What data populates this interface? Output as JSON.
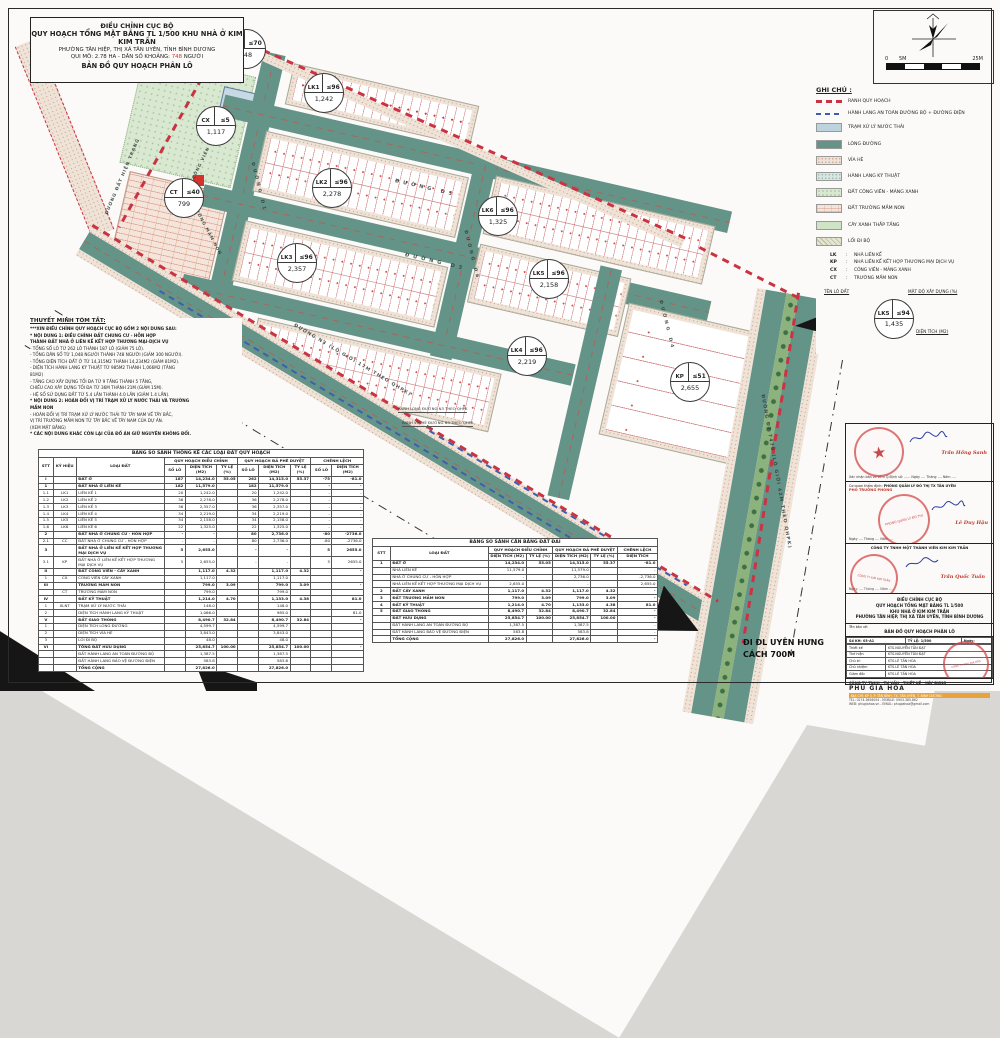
{
  "colors": {
    "road_teal": "#649387",
    "boundary_red": "#c93342",
    "corridor_blue": "#3f5fae",
    "pop_red": "#d4322a",
    "stamp_red": "#cf3e3e"
  },
  "title_block": {
    "line1": "ĐIỀU CHỈNH CỤC BỘ",
    "line2": "QUY HOẠCH TỔNG MẶT BẰNG TL 1/500 KHU NHÀ Ở KIM KIM TRẦN",
    "line3": "PHƯỜNG TÂN HIỆP, THỊ XÃ TÂN UYÊN, TỈNH BÌNH DƯƠNG",
    "line4_pre": "QUI MÔ: 2.78 HA - DÂN SỐ KHOẢNG:",
    "line4_pop": "748",
    "line4_post": "NGƯỜI",
    "line5": "BẢN ĐỒ QUY HOẠCH PHÂN LÔ"
  },
  "north": {
    "scale_0": "0",
    "scale_5": "5M",
    "scale_25": "25M"
  },
  "legend": {
    "title": "GHI CHÚ :",
    "items": [
      {
        "swatch": "dashred",
        "label": "RANH QUY HOẠCH"
      },
      {
        "swatch": "dashblue",
        "label": "HÀNH LANG AN TOÀN ĐƯỜNG BỘ + ĐƯỜNG ĐIỆN"
      },
      {
        "swatch": "wwtp",
        "label": "TRẠM XỬ LÝ NƯỚC THẢI"
      },
      {
        "swatch": "roadc",
        "label": "LÒNG ĐƯỜNG"
      },
      {
        "swatch": "sidewalk",
        "label": "VỈA HÈ"
      },
      {
        "swatch": "tech",
        "label": "HÀNH LANG KỸ THUẬT"
      },
      {
        "swatch": "parkland",
        "label": "ĐẤT CÔNG VIÊN - MẢNG XANH"
      },
      {
        "swatch": "brickp",
        "label": "ĐẤT TRƯỜNG MẦM NON"
      },
      {
        "swatch": "lowgreen",
        "label": "CÂY XANH THẤP TẦNG"
      },
      {
        "swatch": "walk",
        "label": "LỐI ĐI BỘ"
      }
    ],
    "abbrevs": [
      {
        "key": "LK",
        "label": "NHÀ LIÊN KẾ"
      },
      {
        "key": "KP",
        "label": "NHÀ LIÊN KẾ KẾT HỢP THƯƠNG MẠI DỊCH VỤ"
      },
      {
        "key": "CX",
        "label": "CÔNG VIÊN - MẢNG XANH"
      },
      {
        "key": "CT",
        "label": "TRƯỜNG MẦM NON"
      }
    ],
    "key": {
      "lot": "TÊN LÔ ĐẤT",
      "density": "MẬT ĐỘ XÂY DỰNG (%)",
      "area": "DIỆN TÍCH (M2)",
      "example": {
        "code": "LK5",
        "density": "≤94",
        "area": "1,435"
      }
    }
  },
  "notes": {
    "title": "THUYẾT MINH TÓM TẮT:",
    "lines": [
      {
        "t": "***XIN ĐIỀU CHỈNH QUY HOẠCH CỤC BỘ GỒM 2 NỘI DUNG SAU:",
        "b": true
      },
      {
        "t": "* NỘI DUNG 1: ĐIỀU CHỈNH ĐẤT CHUNG CƯ - HỖN HỢP",
        "b": true
      },
      {
        "t": "THÀNH ĐẤT NHÀ Ở LIÊN KẾ KẾT HỢP THƯƠNG MẠI-DỊCH VỤ",
        "b": true
      },
      {
        "t": "- TỔNG SỐ LÔ TỪ 262 LÔ THÀNH 187 LÔ (GIẢM 75 LÔ).",
        "b": false
      },
      {
        "t": "- TỔNG DÂN SỐ TỪ 1,048 NGƯỜI THÀNH 748 NGƯỜI (GIẢM 300 NGƯỜI).",
        "b": false
      },
      {
        "t": "- TỔNG DIỆN TÍCH ĐẤT Ở TỪ 14,315M2 THÀNH 14,234M2 (GIẢM 81M2).",
        "b": false
      },
      {
        "t": "- DIỆN TÍCH HÀNH LANG KỸ THUẬT TỪ 985M2 THÀNH 1,066M2 (TĂNG",
        "b": false
      },
      {
        "t": "81M2)",
        "b": false
      },
      {
        "t": "- TẦNG CAO XÂY DỰNG TỐI ĐA TỪ 9 TẦNG THÀNH 5 TẦNG,",
        "b": false
      },
      {
        "t": "CHIỀU CAO XÂY DỰNG TỐI ĐA TỪ 36M THÀNH 21M (GIẢM 15M).",
        "b": false
      },
      {
        "t": "- HỆ SỐ SỬ DỤNG ĐẤT TỪ 5.4 LẦN THÀNH 4.0 LẦN (GIẢM 1.4 LẦN).",
        "b": false
      },
      {
        "t": "* NỘI DUNG 2: HOÁN ĐỔI VỊ TRÍ TRẠM XỬ LÝ NƯỚC THẢI VÀ TRƯỜNG",
        "b": true
      },
      {
        "t": "MẦM NON",
        "b": true
      },
      {
        "t": "- HOÁN ĐỔI VỊ TRÍ TRẠM XỬ LÝ NƯỚC THẢI TỪ TÂY NAM VỀ TÂY BẮC,",
        "b": false
      },
      {
        "t": "VỊ TRÍ TRƯỜNG MẦM NON TỪ TÂY BẮC VỀ TÂY NAM CỦA DỰ ÁN.",
        "b": false
      },
      {
        "t": "(XEM MẶT BẰNG)",
        "b": false
      },
      {
        "t": "* CÁC NỘI DUNG KHÁC CÒN LẠI CỦA ĐỒ ÁN GIỮ NGUYÊN KHÔNG ĐỔI.",
        "b": true
      }
    ]
  },
  "map": {
    "xlnt_box": "XLNT",
    "parcels": [
      {
        "code": "XLNT",
        "density": "≤70",
        "area": "148",
        "x": 245,
        "y": 48
      },
      {
        "code": "LK1",
        "density": "≤96",
        "area": "1,242",
        "x": 323,
        "y": 92
      },
      {
        "code": "CX",
        "density": "≤5",
        "area": "1,117",
        "x": 215,
        "y": 125
      },
      {
        "code": "CT",
        "density": "≤40",
        "area": "799",
        "x": 183,
        "y": 197
      },
      {
        "code": "LK2",
        "density": "≤96",
        "area": "2,278",
        "x": 331,
        "y": 187
      },
      {
        "code": "LK6",
        "density": "≤96",
        "area": "1,325",
        "x": 497,
        "y": 215
      },
      {
        "code": "LK3",
        "density": "≤96",
        "area": "2,357",
        "x": 296,
        "y": 262
      },
      {
        "code": "LK5",
        "density": "≤96",
        "area": "2,158",
        "x": 548,
        "y": 278
      },
      {
        "code": "LK4",
        "density": "≤96",
        "area": "2,219",
        "x": 526,
        "y": 355
      },
      {
        "code": "KP",
        "density": "≤51",
        "area": "2,655",
        "x": 689,
        "y": 381
      }
    ],
    "road_labels": [
      {
        "text": "ĐƯỜNG  D5",
        "x": 395,
        "y": 178,
        "rot": 13,
        "ls": 4,
        "fs": 5
      },
      {
        "text": "ĐƯỜNG  D3",
        "x": 405,
        "y": 252,
        "rot": 13,
        "ls": 4,
        "fs": 5
      },
      {
        "text": "ĐƯỜNG D1",
        "x": 252,
        "y": 160,
        "rot": 76,
        "ls": 3,
        "fs": 4.5
      },
      {
        "text": "ĐƯỜNG D6",
        "x": 465,
        "y": 228,
        "rot": 76,
        "ls": 3,
        "fs": 4.5
      },
      {
        "text": "ĐƯỜNG D4",
        "x": 660,
        "y": 298,
        "rot": 76,
        "ls": 3,
        "fs": 4.5
      },
      {
        "text": "ĐƯỜNG  N3  (LỘ GIỚI 17M THEO QHPK)",
        "x": 294,
        "y": 323,
        "rot": 31,
        "ls": 1.2,
        "fs": 4.6
      },
      {
        "text": "ĐƯỜNG  ĐT 747B  (LỘ GIỚI 42M THEO QHPK)",
        "x": 762,
        "y": 392,
        "rot": 80,
        "ls": 1.2,
        "fs": 4.6
      },
      {
        "text": "ĐƯỜNG ĐẤT HIỆN TRẠNG",
        "x": 107,
        "y": 212,
        "rot": -67,
        "ls": 1,
        "fs": 4.4
      },
      {
        "text": "CÔNG VIÊN",
        "x": 193,
        "y": 176,
        "rot": -64,
        "ls": 1,
        "fs": 4.2
      },
      {
        "text": "TRƯỜNG MẦM NON",
        "x": 193,
        "y": 200,
        "rot": 62,
        "ls": 1,
        "fs": 4.2
      }
    ],
    "callouts": [
      {
        "text": "RANH LÒNG ĐƯỜNG N3 THEO QHPK",
        "x": 398,
        "y": 406
      },
      {
        "text": "RANH VỈA HÈ ĐƯỜNG N3 THEO QHPK",
        "x": 402,
        "y": 420
      }
    ],
    "direction_line1": "ĐI ĐL UYÊN HƯNG",
    "direction_line2": "CÁCH 700M"
  },
  "table_left": {
    "title": "BẢNG SO SÁNH THỐNG KÊ CÁC LOẠI ĐẤT QUY HOẠCH",
    "groups": [
      "QUY HOẠCH ĐIỀU CHỈNH",
      "QUY HOẠCH ĐÃ PHÊ DUYỆT",
      "CHÊNH LỆCH"
    ],
    "cols": [
      "STT",
      "KÝ HIỆU",
      "LOẠI ĐẤT",
      "SỐ LÔ",
      "DIỆN TÍCH (M2)",
      "TỶ LỆ (%)",
      "SỐ LÔ",
      "DIỆN TÍCH (M2)",
      "TỶ LỆ (%)",
      "SỐ LÔ",
      "DIỆN TÍCH (M2)"
    ],
    "bold_rows": [
      0,
      1,
      8,
      10,
      12,
      14,
      16,
      19,
      23,
      26
    ],
    "rows": [
      [
        "I",
        "",
        "ĐẤT Ở",
        "187",
        "14,234.0",
        "55.05",
        "262",
        "14,315.0",
        "55.37",
        "-75",
        "-81.0"
      ],
      [
        "1",
        "",
        "ĐẤT NHÀ Ở LIÊN KẾ",
        "182",
        "11,579.0",
        "",
        "182",
        "11,579.0",
        "",
        "-",
        "-"
      ],
      [
        "1.1",
        "LK1",
        "LIÊN KẾ 1",
        "20",
        "1,242.0",
        "",
        "20",
        "1,242.0",
        "",
        "-",
        "-"
      ],
      [
        "1.2",
        "LK2",
        "LIÊN KẾ 2",
        "36",
        "2,278.0",
        "",
        "36",
        "2,278.0",
        "",
        "-",
        "-"
      ],
      [
        "1.3",
        "LK3",
        "LIÊN KẾ 3",
        "36",
        "2,357.0",
        "",
        "36",
        "2,357.0",
        "",
        "-",
        "-"
      ],
      [
        "1.4",
        "LK4",
        "LIÊN KẾ 4",
        "34",
        "2,219.0",
        "",
        "34",
        "2,219.0",
        "",
        "-",
        "-"
      ],
      [
        "1.5",
        "LK5",
        "LIÊN KẾ 5",
        "34",
        "2,158.0",
        "",
        "34",
        "2,158.0",
        "",
        "-",
        "-"
      ],
      [
        "1.6",
        "LK6",
        "LIÊN KẾ 6",
        "22",
        "1,325.0",
        "",
        "22",
        "1,325.0",
        "",
        "-",
        "-"
      ],
      [
        "2",
        "",
        "ĐẤT NHÀ Ở CHUNG CƯ - HỖN HỢP",
        "-",
        "-",
        "",
        "80",
        "2,736.0",
        "",
        "-80",
        "-2736.0"
      ],
      [
        "2.1",
        "CC",
        "ĐẤT NHÀ Ở CHUNG CƯ - HỖN HỢP",
        "-",
        "-",
        "",
        "80",
        "2,736.0",
        "",
        "-80",
        "-2736.0"
      ],
      [
        "3",
        "",
        "ĐẤT NHÀ Ở LIÊN KẾ KẾT HỢP THƯƠNG MẠI DỊCH VỤ",
        "5",
        "2,655.0",
        "",
        "-",
        "-",
        "",
        "5",
        "2655.0"
      ],
      [
        "3.1",
        "KP",
        "ĐẤT NHÀ Ở LIÊN KẾ KẾT HỢP THƯƠNG MẠI DỊCH VỤ",
        "5",
        "2,655.0",
        "",
        "-",
        "-",
        "",
        "5",
        "2655.0"
      ],
      [
        "II",
        "",
        "ĐẤT CÔNG VIÊN - CÂY XANH",
        "",
        "1,117.0",
        "4.32",
        "",
        "1,117.0",
        "4.32",
        "",
        "-"
      ],
      [
        "1",
        "CX",
        "CÔNG VIÊN CÂY XANH",
        "",
        "1,117.0",
        "",
        "",
        "1,117.0",
        "",
        "",
        ""
      ],
      [
        "III",
        "",
        "TRƯỜNG MẦM NON",
        "",
        "799.0",
        "3.09",
        "",
        "799.0",
        "3.09",
        "",
        "-"
      ],
      [
        "",
        "CT",
        "TRƯỜNG MẦM NON",
        "",
        "799.0",
        "",
        "",
        "799.0",
        "",
        "",
        ""
      ],
      [
        "IV",
        "",
        "ĐẤT KỸ THUẬT",
        "",
        "1,214.0",
        "4.70",
        "",
        "1,133.0",
        "4.38",
        "",
        "81.0"
      ],
      [
        "1",
        "XLNT",
        "TRẠM XỬ LÝ NƯỚC THẢI",
        "",
        "148.0",
        "",
        "",
        "148.0",
        "",
        "",
        ""
      ],
      [
        "2",
        "",
        "DIỆN TÍCH HÀNH LANG KỸ THUẬT",
        "",
        "1,066.0",
        "",
        "",
        "985.0",
        "",
        "",
        "81.0"
      ],
      [
        "V",
        "",
        "ĐẤT GIAO THÔNG",
        "",
        "8,490.7",
        "32.84",
        "",
        "8,490.7",
        "32.84",
        "",
        "-"
      ],
      [
        "1",
        "",
        "DIỆN TÍCH LÒNG ĐƯỜNG",
        "",
        "4,599.7",
        "",
        "",
        "4,599.7",
        "",
        "",
        ""
      ],
      [
        "2",
        "",
        "DIỆN TÍCH VỈA HÈ",
        "",
        "3,843.0",
        "",
        "",
        "3,843.0",
        "",
        "",
        ""
      ],
      [
        "3",
        "",
        "LỐI ĐI BỘ",
        "",
        "48.0",
        "",
        "",
        "48.0",
        "",
        "",
        ""
      ],
      [
        "VI",
        "",
        "TỔNG ĐẤT HỮU DỤNG",
        "",
        "25,854.7",
        "100.00",
        "",
        "25,854.7",
        "100.00",
        "",
        "-"
      ],
      [
        "",
        "",
        "ĐẤT HÀNH LANG AN TOÀN ĐƯỜNG BỘ",
        "",
        "1,387.5",
        "",
        "",
        "1,387.5",
        "",
        "",
        ""
      ],
      [
        "",
        "",
        "ĐẤT HÀNH LANG BẢO VỆ ĐƯỜNG ĐIỆN",
        "",
        "583.8",
        "",
        "",
        "583.8",
        "",
        "",
        ""
      ],
      [
        "",
        "",
        "TỔNG CỘNG",
        "",
        "27,826.0",
        "",
        "",
        "27,826.0",
        "",
        "",
        ""
      ]
    ]
  },
  "table_right": {
    "title": "BẢNG SO SÁNH CÂN BẰNG ĐẤT ĐAI",
    "groups": [
      "QUY HOẠCH ĐIỀU CHỈNH",
      "QUY HOẠCH ĐÃ PHÊ DUYỆT",
      "CHÊNH LỆCH"
    ],
    "cols": [
      "STT",
      "LOẠI ĐẤT"
    ],
    "subcols": [
      "DIỆN TÍCH (M2)",
      "TỶ LỆ (%)",
      "DIỆN TÍCH (M2)",
      "TỶ LỆ (%)",
      "DIỆN TÍCH"
    ],
    "bold_rows": [
      0,
      4,
      5,
      6,
      7,
      8,
      11
    ],
    "rows": [
      [
        "1",
        "ĐẤT Ở",
        "14,234.0",
        "55.05",
        "14,315.0",
        "55.37",
        "-81.0"
      ],
      [
        "",
        "NHÀ LIÊN KẾ",
        "11,579.0",
        "",
        "11,579.0",
        "",
        "-"
      ],
      [
        "",
        "NHÀ Ở CHUNG CƯ - HỖN HỢP",
        "-",
        "",
        "2,736.0",
        "",
        "-2,736.0"
      ],
      [
        "",
        "NHÀ LIÊN KẾ KẾT HỢP THƯƠNG MẠI DỊCH VỤ",
        "2,655.0",
        "",
        "-",
        "",
        "2,655.0"
      ],
      [
        "2",
        "ĐẤT CÂY XANH",
        "1,117.0",
        "4.32",
        "1,117.0",
        "4.32",
        "-"
      ],
      [
        "3",
        "ĐẤT TRƯỜNG MẦM NON",
        "799.0",
        "3.09",
        "799.0",
        "3.09",
        "-"
      ],
      [
        "4",
        "ĐẤT KỸ THUẬT",
        "1,214.0",
        "4.70",
        "1,133.0",
        "4.38",
        "81.0"
      ],
      [
        "5",
        "ĐẤT GIAO THÔNG",
        "8,490.7",
        "32.84",
        "8,490.7",
        "32.84",
        "-"
      ],
      [
        "",
        "ĐẤT HỮU DỤNG",
        "25,854.7",
        "100.00",
        "25,854.7",
        "100.00",
        "-"
      ],
      [
        "",
        "ĐẤT HÀNH LANG AN TOÀN ĐƯỜNG BỘ",
        "1,387.5",
        "",
        "1,387.5",
        "",
        "-"
      ],
      [
        "",
        "ĐẤT HÀNH LANG BẢO VỆ ĐƯỜNG ĐIỆN",
        "583.8",
        "",
        "583.8",
        "",
        "-"
      ],
      [
        "",
        "TỔNG CỘNG",
        "27,826.0",
        "",
        "27,826.0",
        "",
        "-"
      ]
    ]
  },
  "approval": {
    "sign1_name": "Trần Hồng Sanh",
    "row1_line": "Xác nhận bản vẽ kèm Q.Định số: ......  Ngày .... Tháng .... Năm ....",
    "agency_label": "Cơ quan thẩm định:",
    "agency": "PHÒNG QUẢN LÝ ĐÔ THỊ TX TÂN UYÊN",
    "agency_role": "PHÓ TRƯỞNG PHÒNG",
    "stamp2_text": "PHÒNG QUẢN LÝ ĐÔ THỊ",
    "sign2_name": "Lê Duy Hậu",
    "row2_line": "Ngày .... Tháng .... Năm ....",
    "owner": "CÔNG TY TNHH MỘT THÀNH VIÊN KIM KIM TRẦN",
    "sign3_name": "Trần Quốc Tuấn",
    "row3_line": "Ngày .... Tháng .... Năm ....",
    "project_lines": [
      "ĐIỀU CHỈNH CỤC BỘ",
      "QUY HOẠCH TỔNG MẶT BẰNG TL 1/500",
      "KHU NHÀ Ở KIM KIM TRẦN",
      "PHƯỜNG TÂN HIỆP, THỊ XÃ TÂN UYÊN, TỈNH BÌNH DƯƠNG"
    ],
    "drawing_label": "Tên bản vẽ:",
    "drawing_name": "BẢN ĐỒ QUY HOẠCH PHÂN LÔ",
    "roles_header": [
      "Số KH: 03-A1",
      "TỶ LỆ: 1/500",
      "Ngày:"
    ],
    "roles": [
      [
        "Thiết kế",
        "KTS.NGUYỄN TẤN ĐẠT"
      ],
      [
        "Thể hiện",
        "KTS.NGUYỄN TẤN ĐẠT"
      ],
      [
        "Chủ trì",
        "KTS.LÊ TẤN HÒA"
      ],
      [
        "Chủ nhiệm",
        "KTS.LÊ TẤN HÒA"
      ],
      [
        "Giám đốc",
        "KTS.LÊ TẤN HÒA"
      ]
    ],
    "company_line": "CÔNG TY TNHH - TƯ VẤN - THIẾT KẾ - XÂY DỰNG",
    "company_name": "PHÚ GIA HÒA",
    "company_addr": "ĐỊA CHỈ: KP 3, P. TÂN BÌNH, TX. TÂN UYÊN, T. BÌNH DƯƠNG",
    "company_tel": "TEL: 0274.3656054 - MOBILE: 0903.385.862",
    "company_web": "WEB: phugiahoa.vn - EMAIL: phugiahoa@gmail.com"
  }
}
